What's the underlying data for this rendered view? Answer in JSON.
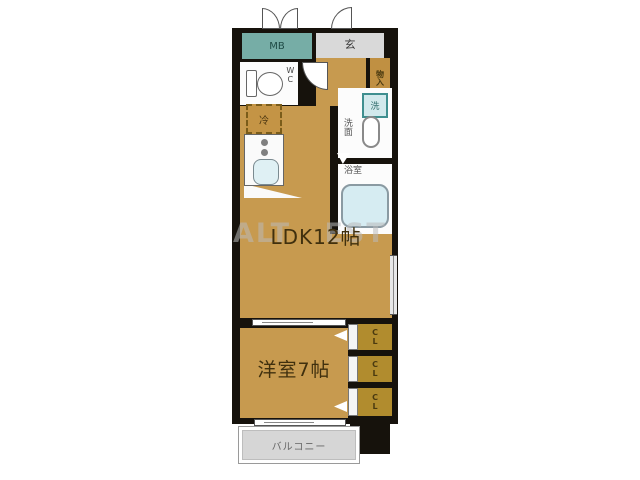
{
  "floorplan": {
    "watermark": "ALT EST",
    "rooms": {
      "meter_box": "MB",
      "entrance": "玄",
      "wc": "WC",
      "storage": "物入",
      "fridge": "冷",
      "washer": "洗",
      "washroom": "洗面",
      "bathroom": "浴室",
      "ldk": "LDK12帖",
      "western_room": "洋室7帖",
      "closet": "CL",
      "balcony": "バルコニー"
    }
  }
}
